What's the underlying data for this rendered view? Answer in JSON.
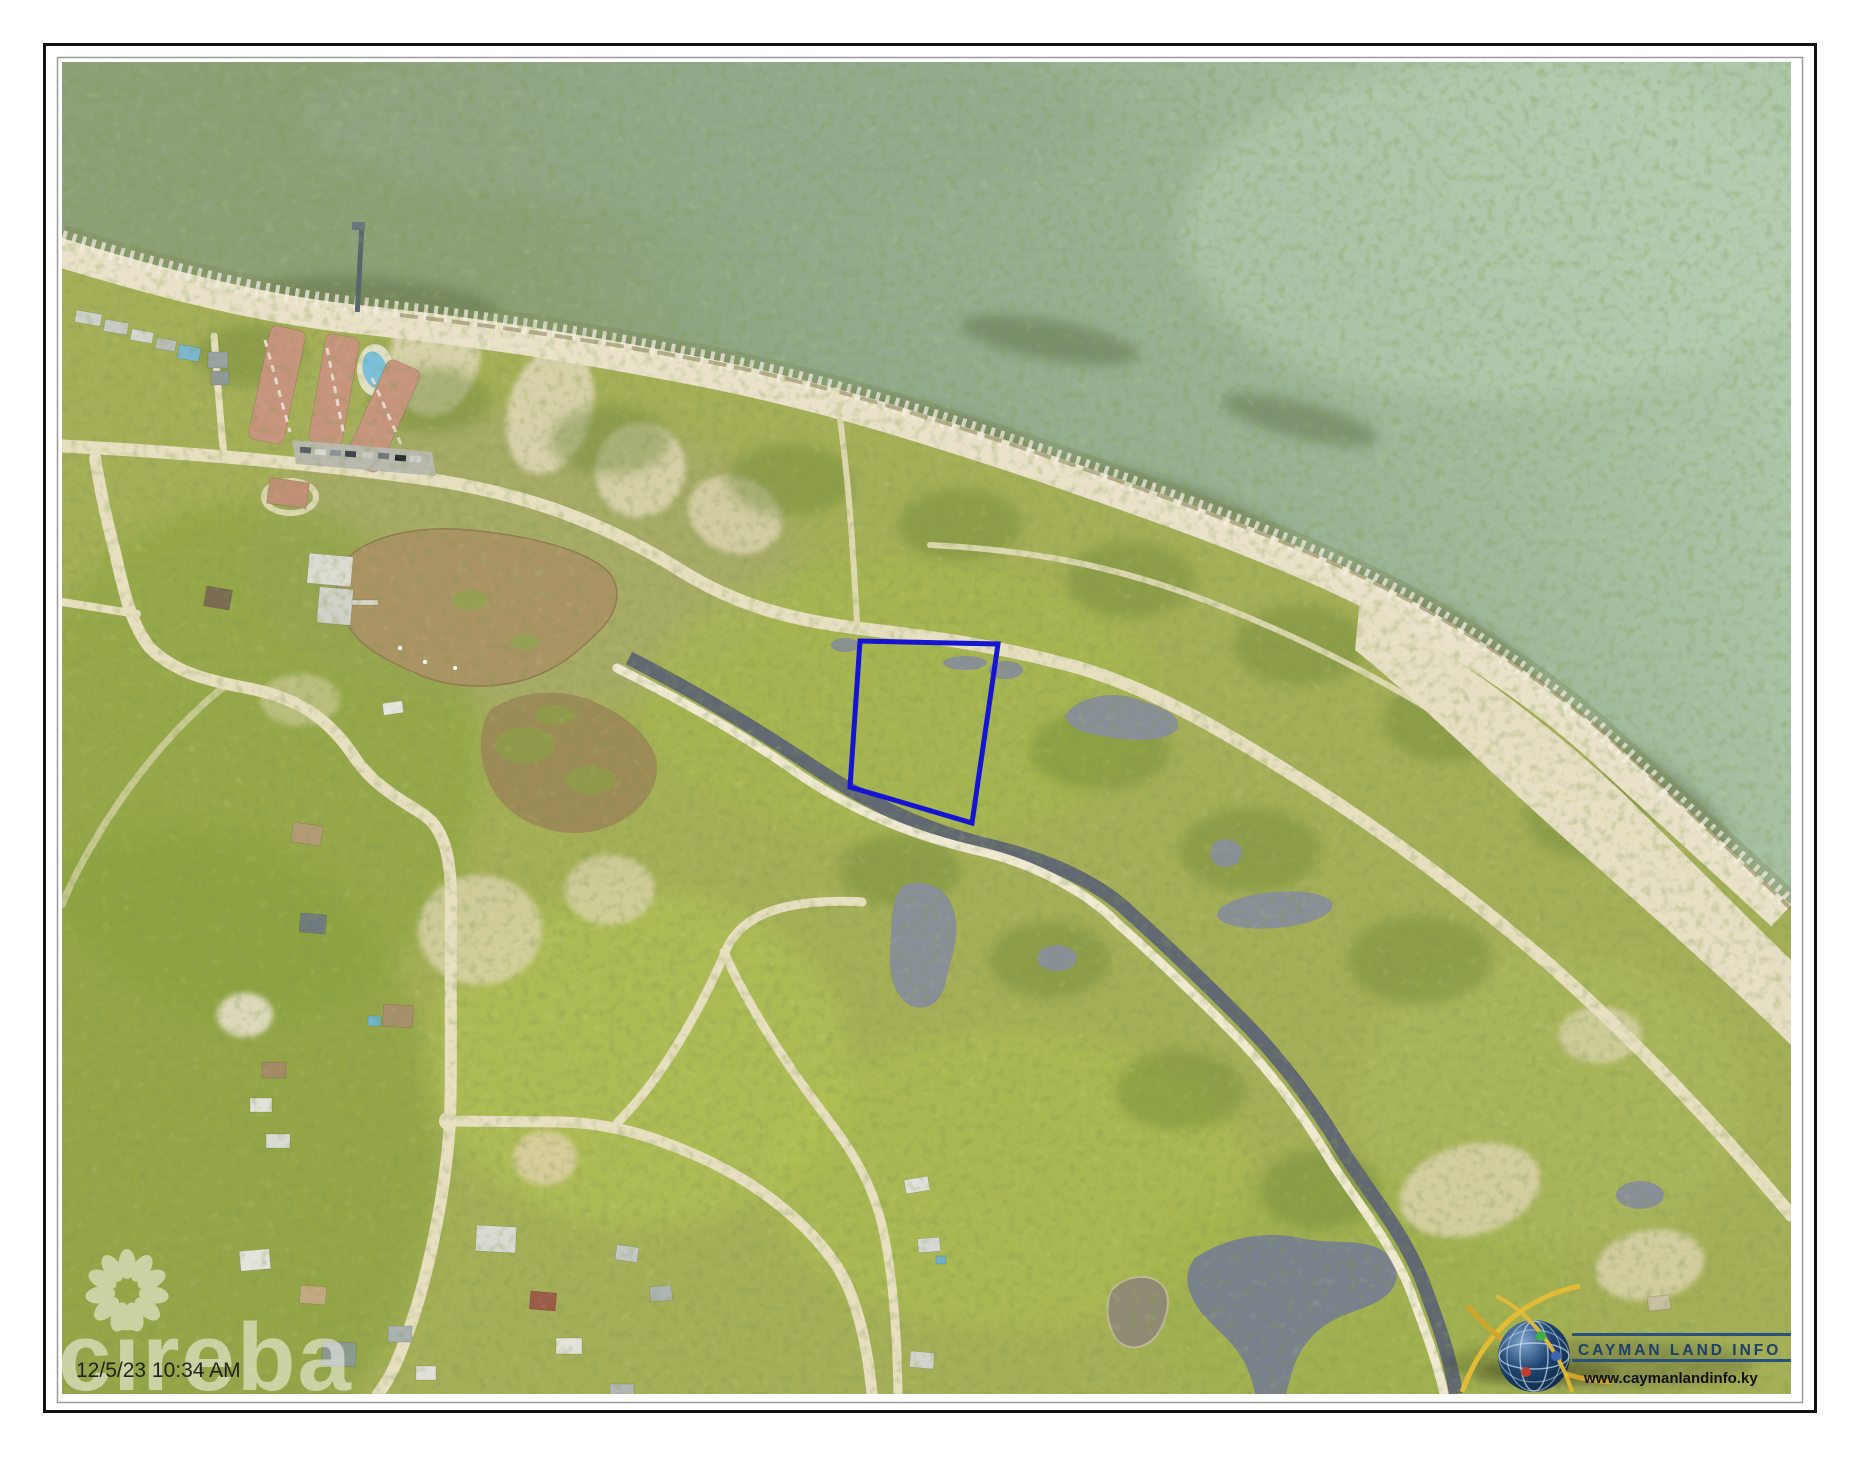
{
  "map": {
    "timestamp": "12/5/23 10:34 AM",
    "watermark": {
      "text": "cireba"
    },
    "logo": {
      "title": "CAYMAN LAND INFO",
      "url": "www.caymanlandinfo.ky",
      "title_color": "#1c3f6c",
      "accent_yellow": "#e3bb35"
    },
    "parcel": {
      "outline_color": "#1414d2"
    },
    "palette": {
      "vegetation": "#a5af57",
      "forest": "#7f9a3c",
      "sea": "#9ab394",
      "beach": "#e9e2c9",
      "road": "#e6dfc0",
      "pond_brown": "#ab9464",
      "pond_gray": "#898f96",
      "canal": "#616871",
      "condo_roof": "#c7947e",
      "pool": "#79c0d8"
    }
  }
}
